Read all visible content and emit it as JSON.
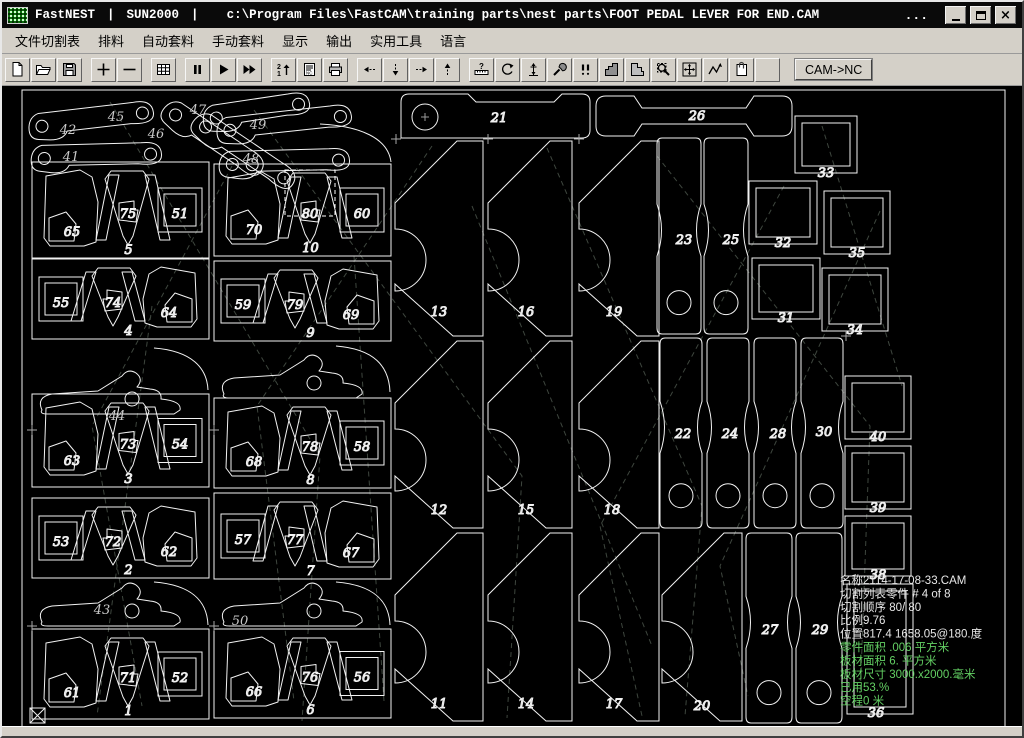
{
  "title_bar": {
    "app": "FastNEST",
    "separator": "|",
    "profile": "SUN2000",
    "path": "c:\\Program Files\\FastCAM\\training parts\\nest parts\\FOOT PEDAL LEVER FOR END.CAM",
    "overflow_dots": "...",
    "window_buttons": [
      "minimize",
      "restore",
      "close"
    ]
  },
  "menu_bar": {
    "items": [
      "文件切割表",
      "排料",
      "自动套料",
      "手动套料",
      "显示",
      "输出",
      "实用工具",
      "语言"
    ]
  },
  "toolbar": {
    "cam_nc_label": "CAM->NC",
    "buttons": [
      {
        "name": "new-document-icon"
      },
      {
        "name": "open-file-icon"
      },
      {
        "name": "save-icon"
      },
      {
        "name": "zoom-in-icon",
        "gap": true
      },
      {
        "name": "zoom-out-icon"
      },
      {
        "name": "plate-grid-icon",
        "gap": true
      },
      {
        "name": "pause-icon",
        "gap": true
      },
      {
        "name": "run-icon"
      },
      {
        "name": "fast-run-icon"
      },
      {
        "name": "sequence-icon",
        "gap": true
      },
      {
        "name": "nc-code-icon"
      },
      {
        "name": "print-icon"
      },
      {
        "name": "move-left-icon",
        "gap": true
      },
      {
        "name": "move-down-icon"
      },
      {
        "name": "move-right-icon"
      },
      {
        "name": "move-up-icon"
      },
      {
        "name": "measure-icon",
        "gap": true
      },
      {
        "name": "rotate-icon"
      },
      {
        "name": "datum-icon"
      },
      {
        "name": "tools-icon"
      },
      {
        "name": "pierce-icon"
      },
      {
        "name": "part-shape-icon"
      },
      {
        "name": "plate-shape-icon"
      },
      {
        "name": "zoom-window-icon"
      },
      {
        "name": "pan-icon"
      },
      {
        "name": "path-icon"
      },
      {
        "name": "report-icon"
      },
      {
        "name": "blank-button"
      }
    ]
  },
  "colors": {
    "canvas_bg": "#000000",
    "outline": "#f2f2f2",
    "label": "#c9c9c9",
    "traverse": "#3e463e",
    "info_white": "#e8e8e8",
    "info_green": "#63cf63",
    "chrome": "#d4d0c8",
    "selection": "#ffffff"
  },
  "nest": {
    "sheet": {
      "x": 20,
      "y": 84,
      "w": 983,
      "h": 638
    },
    "info_panel": {
      "x": 838,
      "y": 578,
      "line_height": 13.4,
      "lines": [
        {
          "text": "名称2114-17-08-33.CAM",
          "green": false
        },
        {
          "text": "切割列表零件  # 4 of  8",
          "green": false
        },
        {
          "text": "切割顺序 80/ 80",
          "green": false
        },
        {
          "text": "比例9.76",
          "green": false
        },
        {
          "text": "位置817.4 1658.05@180.度",
          "green": false
        },
        {
          "text": "零件面积  .006 平方米",
          "green": true
        },
        {
          "text": "板材面积 6. 平方米",
          "green": true
        },
        {
          "text": "板材尺寸  3000.x2000.毫米",
          "green": true
        },
        {
          "text": "已用53.%",
          "green": true
        },
        {
          "text": "空程0 米",
          "green": true
        }
      ]
    },
    "modules": [
      {
        "x": 30,
        "y": 156,
        "w": 177,
        "h": 96,
        "label": "5",
        "mirror": false,
        "blob": "65",
        "center": "75",
        "square": "51"
      },
      {
        "x": 30,
        "y": 253,
        "w": 177,
        "h": 80,
        "label": "4",
        "mirror": true,
        "blob": "64",
        "center": "74",
        "square": "55"
      },
      {
        "x": 30,
        "y": 388,
        "w": 177,
        "h": 93,
        "label": "3",
        "mirror": false,
        "blob": "63",
        "center": "73",
        "square": "54"
      },
      {
        "x": 30,
        "y": 492,
        "w": 177,
        "h": 80,
        "label": "2",
        "mirror": true,
        "blob": "62",
        "center": "72",
        "square": "53"
      },
      {
        "x": 30,
        "y": 623,
        "w": 177,
        "h": 90,
        "label": "1",
        "mirror": false,
        "blob": "61",
        "center": "71",
        "square": "52"
      },
      {
        "x": 212,
        "y": 158,
        "w": 177,
        "h": 92,
        "label": "10",
        "mirror": false,
        "blob": "70",
        "center": "80",
        "square": "60"
      },
      {
        "x": 212,
        "y": 255,
        "w": 177,
        "h": 80,
        "label": "9",
        "mirror": true,
        "blob": "69",
        "center": "79",
        "square": "59"
      },
      {
        "x": 212,
        "y": 392,
        "w": 177,
        "h": 90,
        "label": "8",
        "mirror": false,
        "blob": "68",
        "center": "78",
        "square": "58"
      },
      {
        "x": 212,
        "y": 487,
        "w": 177,
        "h": 86,
        "label": "7",
        "mirror": true,
        "blob": "67",
        "center": "77",
        "square": "57"
      },
      {
        "x": 212,
        "y": 623,
        "w": 177,
        "h": 89,
        "label": "6",
        "mirror": false,
        "blob": "66",
        "center": "76",
        "square": "56"
      }
    ],
    "levers": [
      {
        "type": "link",
        "x": 26,
        "y": 102,
        "len": 128,
        "rot": -3,
        "label": "42",
        "lx": 66,
        "ly": 128
      },
      {
        "type": "link",
        "x": 30,
        "y": 133,
        "len": 133,
        "rot": 2,
        "label": "41",
        "lx": 69,
        "ly": 155
      },
      {
        "type": "link",
        "x": 175,
        "y": 86,
        "len": 118,
        "rot": 38,
        "label": "45",
        "lx": 114,
        "ly": 115
      },
      {
        "type": "link",
        "x": 205,
        "y": 98,
        "len": 120,
        "rot": 38,
        "label": "46",
        "lx": 154,
        "ly": 132
      },
      {
        "type": "link",
        "x": 200,
        "y": 94,
        "len": 110,
        "rot": -4,
        "label": "47",
        "lx": 196,
        "ly": 108
      },
      {
        "type": "link",
        "x": 214,
        "y": 106,
        "len": 138,
        "rot": -3,
        "label": "49",
        "lx": 256,
        "ly": 123
      },
      {
        "type": "link",
        "x": 218,
        "y": 139,
        "len": 133,
        "rot": 2,
        "label": "48",
        "lx": 249,
        "ly": 157
      },
      {
        "type": "pedal",
        "x": 34,
        "y": 362,
        "label": "44",
        "lx": 115,
        "ly": 414
      },
      {
        "type": "pedal",
        "x": 216,
        "y": 346,
        "label": "",
        "lx": 0,
        "ly": 0
      },
      {
        "type": "pedal",
        "x": 34,
        "y": 574,
        "label": "43",
        "lx": 100,
        "ly": 608
      },
      {
        "type": "pedal",
        "x": 216,
        "y": 574,
        "label": "50",
        "lx": 238,
        "ly": 619
      }
    ],
    "arcs": [
      "M318,118 C358,120 386,132 389,156",
      "M152,342 C190,345 205,362 206,384",
      "M334,340 C372,343 387,360 388,386",
      "M152,576 C190,579 205,595 206,619",
      "M334,576 C372,579 387,595 388,619"
    ],
    "tall_parts": [
      {
        "x": 393,
        "y": 135,
        "w": 88,
        "h": 195,
        "label": "13",
        "lx": 437,
        "ly": 310
      },
      {
        "x": 393,
        "y": 335,
        "w": 88,
        "h": 187,
        "label": "12",
        "lx": 437,
        "ly": 508
      },
      {
        "x": 393,
        "y": 527,
        "w": 88,
        "h": 188,
        "label": "11",
        "lx": 437,
        "ly": 702
      },
      {
        "x": 486,
        "y": 135,
        "w": 84,
        "h": 195,
        "label": "16",
        "lx": 524,
        "ly": 310
      },
      {
        "x": 486,
        "y": 335,
        "w": 84,
        "h": 187,
        "label": "15",
        "lx": 524,
        "ly": 508
      },
      {
        "x": 486,
        "y": 527,
        "w": 84,
        "h": 188,
        "label": "14",
        "lx": 524,
        "ly": 702
      },
      {
        "x": 577,
        "y": 135,
        "w": 80,
        "h": 195,
        "label": "19",
        "lx": 612,
        "ly": 310
      },
      {
        "x": 577,
        "y": 335,
        "w": 80,
        "h": 187,
        "label": "18",
        "lx": 610,
        "ly": 508
      },
      {
        "x": 577,
        "y": 527,
        "w": 80,
        "h": 188,
        "label": "17",
        "lx": 612,
        "ly": 702
      },
      {
        "x": 660,
        "y": 527,
        "w": 80,
        "h": 188,
        "label": "20",
        "lx": 700,
        "ly": 704
      }
    ],
    "bars": [
      {
        "label": "21",
        "lx": 497,
        "ly": 116,
        "hole": true,
        "path": "M399,132 L399,96 Q399,88 407,88 L466,88 L474,96 L552,96 L560,88 L580,88 Q588,88 588,96 L588,124 Q588,132 580,132 Z",
        "hx": 423,
        "hy": 111,
        "hr": 13
      },
      {
        "label": "26",
        "lx": 695,
        "ly": 114,
        "hole": false,
        "path": "M594,100 Q594,90 604,90 L632,90 L640,102 L744,102 L752,90 L780,90 Q790,90 790,100 L790,120 Q790,130 780,130 L752,130 L744,118 L640,118 L632,130 L604,130 Q594,130 594,120 Z",
        "hx": 0,
        "hy": 0,
        "hr": 0
      }
    ],
    "strips": [
      {
        "x": 655,
        "y": 132,
        "w": 44,
        "h": 196,
        "label": "23",
        "lx": 682,
        "ly": 238,
        "holeRel": 0.84
      },
      {
        "x": 702,
        "y": 132,
        "w": 44,
        "h": 196,
        "label": "25",
        "lx": 729,
        "ly": 238,
        "holeRel": 0.84
      },
      {
        "x": 658,
        "y": 332,
        "w": 42,
        "h": 190,
        "label": "22",
        "lx": 681,
        "ly": 432,
        "holeRel": 0.83
      },
      {
        "x": 705,
        "y": 332,
        "w": 42,
        "h": 190,
        "label": "24",
        "lx": 728,
        "ly": 432,
        "holeRel": 0.83
      },
      {
        "x": 752,
        "y": 332,
        "w": 42,
        "h": 190,
        "label": "28",
        "lx": 776,
        "ly": 432,
        "holeRel": 0.83
      },
      {
        "x": 799,
        "y": 332,
        "w": 42,
        "h": 190,
        "label": "30",
        "lx": 822,
        "ly": 430,
        "holeRel": 0.83
      },
      {
        "x": 744,
        "y": 527,
        "w": 46,
        "h": 190,
        "label": "27",
        "lx": 768,
        "ly": 628,
        "holeRel": 0.84
      },
      {
        "x": 794,
        "y": 527,
        "w": 46,
        "h": 190,
        "label": "29",
        "lx": 818,
        "ly": 628,
        "holeRel": 0.84
      }
    ],
    "squares": [
      {
        "x": 793,
        "y": 110,
        "w": 62,
        "h": 57,
        "label": "33",
        "lx": 824,
        "ly": 171
      },
      {
        "x": 747,
        "y": 175,
        "w": 68,
        "h": 63,
        "label": "32",
        "lx": 781,
        "ly": 241
      },
      {
        "x": 822,
        "y": 185,
        "w": 66,
        "h": 63,
        "label": "35",
        "lx": 855,
        "ly": 251
      },
      {
        "x": 750,
        "y": 252,
        "w": 68,
        "h": 61,
        "label": "31",
        "lx": 784,
        "ly": 316
      },
      {
        "x": 820,
        "y": 262,
        "w": 66,
        "h": 63,
        "label": "34",
        "lx": 853,
        "ly": 328
      },
      {
        "x": 843,
        "y": 370,
        "w": 66,
        "h": 63,
        "label": "40",
        "lx": 876,
        "ly": 435
      },
      {
        "x": 843,
        "y": 440,
        "w": 66,
        "h": 63,
        "label": "39",
        "lx": 876,
        "ly": 506
      },
      {
        "x": 843,
        "y": 510,
        "w": 66,
        "h": 60,
        "label": "38",
        "lx": 876,
        "ly": 573
      },
      {
        "x": 845,
        "y": 578,
        "w": 66,
        "h": 130,
        "label": "36",
        "lx": 874,
        "ly": 711
      }
    ],
    "selected_part": "80",
    "selection_box": {
      "x": 283,
      "y": 164,
      "w": 50,
      "h": 46
    },
    "origin_marker": {
      "x": 28,
      "y": 702,
      "size": 15
    },
    "crosses": [
      [
        30,
        424
      ],
      [
        212,
        424
      ],
      [
        30,
        620
      ],
      [
        212,
        620
      ],
      [
        394,
        133
      ],
      [
        486,
        133
      ],
      [
        577,
        133
      ],
      [
        844,
        330
      ]
    ],
    "traverse_lines": [
      [
        108,
        96,
        318,
        450,
        300,
        715
      ],
      [
        252,
        104,
        520,
        470,
        505,
        712
      ],
      [
        430,
        140,
        255,
        400,
        292,
        695
      ],
      [
        545,
        142,
        700,
        500,
        683,
        710
      ],
      [
        655,
        150,
        868,
        420,
        858,
        695
      ],
      [
        782,
        180,
        598,
        520,
        640,
        710
      ],
      [
        878,
        205,
        718,
        560,
        746,
        690
      ],
      [
        352,
        250,
        382,
        695
      ],
      [
        150,
        300,
        95,
        710
      ],
      [
        230,
        160,
        90,
        420,
        140,
        700
      ],
      [
        470,
        200,
        650,
        640
      ],
      [
        820,
        120,
        900,
        380
      ]
    ]
  }
}
